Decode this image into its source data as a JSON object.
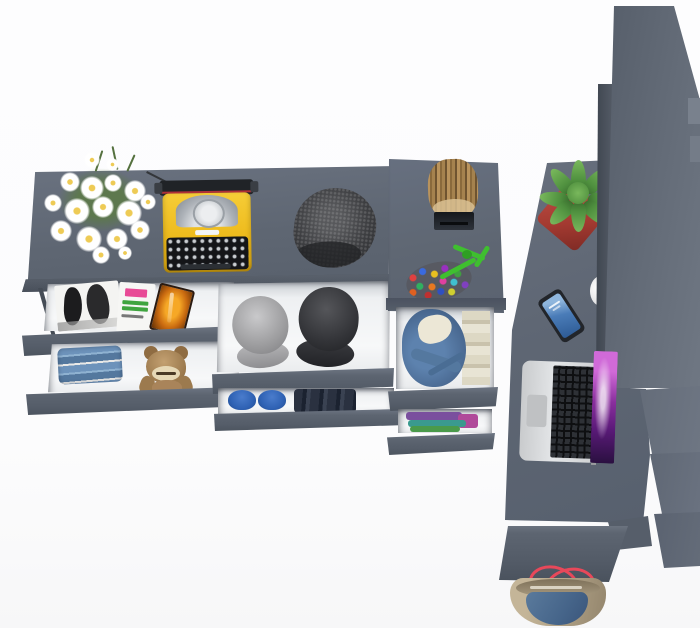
{
  "scene": {
    "description": "Top-down 3D render of a dark gray modular hallway furniture set with open drawers and styled props on a white background",
    "background_color": "#fdfdfe",
    "palette": {
      "furniture_gray": "#616975",
      "drawer_front_gray": "#5b6370",
      "drawer_interior_white": "#eef0f2",
      "panel_dark_edge": "#49505a"
    },
    "structure": {
      "console": {
        "label": "Wall console tabletop with props"
      },
      "drawers_left": {
        "label": "Open drawers with magazines, folded jeans and a teddy bear"
      },
      "drawers_middle": {
        "label": "Open drawers with two caps, blue shoes and folded dark clothes"
      },
      "tower": {
        "label": "Cabinet column with log stool, hook, pompom keychain and clothes drawers"
      },
      "desk_right": {
        "label": "Desk column with smartphone and laptop"
      },
      "wardrobe_panel": {
        "label": "Tall wardrobe side panel seen edge-on"
      },
      "bench_steps": {
        "label": "Stepped bench panels descending to the floor"
      },
      "bench_bottom": {
        "label": "Bottom bench slab above tote bag"
      }
    },
    "objects": {
      "flowers": {
        "label": "White daisy bouquet",
        "petal_color": "#ffffff",
        "center_color": "#eecb55",
        "stem_color": "#55713f"
      },
      "typewriter": {
        "label": "Yellow vintage typewriter",
        "body_color": "#f2c226",
        "key_color": "#121316",
        "platen_color": "#202327",
        "ribbon_line_color": "#b03038"
      },
      "beanie": {
        "label": "Dark gray knit beanie hat",
        "color": "#3a3b3e"
      },
      "stool": {
        "label": "Wooden log stool",
        "color": "#a8854f"
      },
      "hook": {
        "label": "Black wall hook",
        "color": "#15181c"
      },
      "pompom": {
        "label": "Multicolor pompom keychain with green cord",
        "cord_color": "#3fbf2f",
        "dot_colors": [
          "#e04040",
          "#3a6ae0",
          "#e8c020",
          "#9a30c0",
          "#30b060",
          "#e87820",
          "#e040a0",
          "#40c0d0"
        ]
      },
      "cactus": {
        "label": "Green succulent in a red pot",
        "plant_color": "#4e8f3e",
        "pot_color": "#a93b33"
      },
      "magazine_bw": {
        "label": "Black-and-white fashion magazine",
        "color": "#f4f4f2"
      },
      "magazine_color": {
        "label": "Magazine with pink and green cover text",
        "accent_pink": "#e84a96",
        "accent_green": "#3fa43f"
      },
      "magazine_orange": {
        "label": "Orange-cover magazine",
        "color": "#e08018"
      },
      "jeans": {
        "label": "Stack of folded blue jeans",
        "color": "#5d83ab"
      },
      "teddy": {
        "label": "Brown teddy bear",
        "fur_color": "#a9845a",
        "muzzle_color": "#e6d8b6"
      },
      "cap_gray": {
        "label": "Gray cap",
        "color": "#9c9c9e"
      },
      "cap_black": {
        "label": "Black cap",
        "color": "#303134"
      },
      "shoes": {
        "label": "Pair of blue shoes",
        "color": "#2f62b4"
      },
      "folded_dark_clothes": {
        "label": "Folded dark navy clothes",
        "color": "#272e3a"
      },
      "denim_jacket": {
        "label": "Blue denim jacket with cream lining in drawer",
        "color": "#4f739e",
        "lining_color": "#ece7d6"
      },
      "folded_bright_clothes": {
        "label": "Folded purple, teal and green clothes",
        "colors": [
          "#7a4f9e",
          "#3a9a8e",
          "#4a9a4a"
        ]
      },
      "smartphone": {
        "label": "Smartphone with blue lock screen",
        "body_color": "#22252a",
        "screen_color": "#4a7cb8"
      },
      "laptop": {
        "label": "Open silver laptop with purple galaxy wallpaper",
        "body_color": "#d5d7d9",
        "key_color": "#111215",
        "screen_colors": [
          "#d06ad8",
          "#8a2f9e",
          "#2a1040"
        ]
      },
      "white_item": {
        "label": "White object partly hidden behind panel",
        "color": "#ececee"
      },
      "tote_bag": {
        "label": "Tan and denim tote bag with red straps",
        "body_color": "#b3a489",
        "panel_color": "#46658a",
        "strap_color": "#e8485a"
      }
    }
  }
}
